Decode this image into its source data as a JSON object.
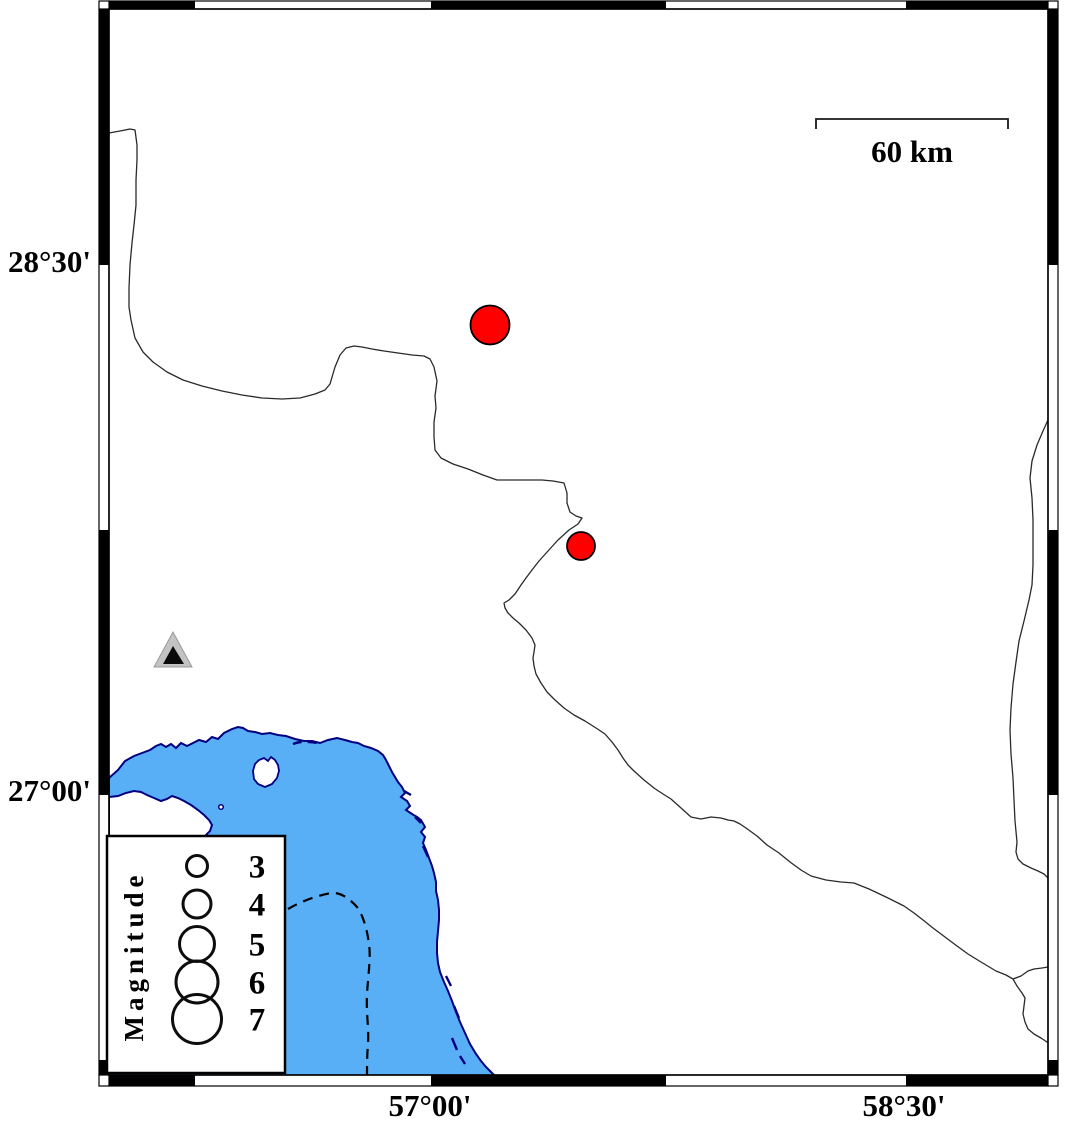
{
  "figure": {
    "type": "seismicity-map",
    "description": "Black-and-white checkered GMT-style map frame with coastline, sea area, province boundary lines, two earthquake epicenters and one station triangle"
  },
  "axes": {
    "lat_labels": [
      {
        "text": "28°30'"
      },
      {
        "text": "27°00'"
      }
    ],
    "lon_labels": [
      {
        "text": "57°00'"
      },
      {
        "text": "58°30'"
      }
    ]
  },
  "scale_bar": {
    "label": "60 km",
    "length_px": 192
  },
  "legend": {
    "title": "Magnitude",
    "entries": [
      {
        "label": "3",
        "r": 10.5
      },
      {
        "label": "4",
        "r": 14
      },
      {
        "label": "5",
        "r": 17.5
      },
      {
        "label": "6",
        "r": 21
      },
      {
        "label": "7",
        "r": 24.5
      }
    ]
  },
  "markers": {
    "earthquakes": [
      {
        "x": 490,
        "y": 325,
        "r": 19.5
      },
      {
        "x": 581,
        "y": 546,
        "r": 14
      }
    ],
    "stations": [
      {
        "x": 173,
        "y": 651
      }
    ]
  },
  "colors": {
    "water": "#58AFF6",
    "coast": "#000080",
    "boundary": "#2a2a2a",
    "earthquake": "#FF0000",
    "station_gray": "#c3c3c3",
    "station_core": "#0a0a0a",
    "frame": "#000000"
  }
}
